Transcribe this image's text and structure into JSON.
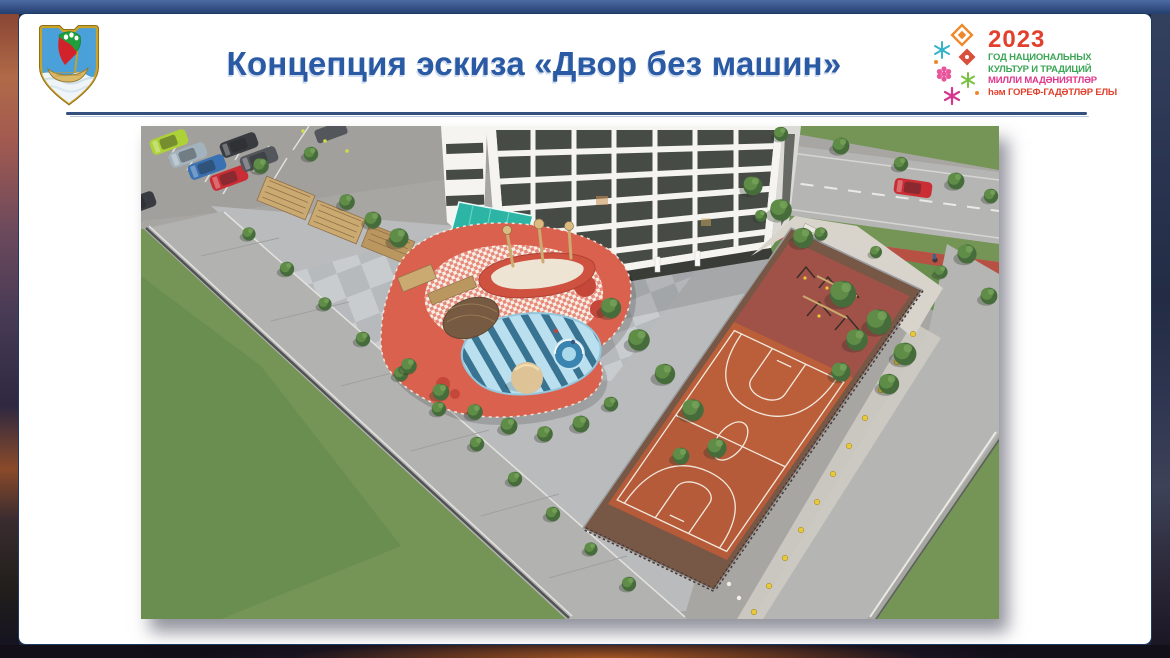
{
  "background": {
    "top_bar_color": "#39558c",
    "edges": {
      "left": "sunset-city-photo",
      "right": "night-city-photo",
      "bottom": "night-road-photo"
    }
  },
  "slide": {
    "title": "Концепция эскиза «Двор без машин»",
    "title_color": "#2b5aa5",
    "divider_color": "#33507e"
  },
  "emblem": {
    "name": "city-coat-of-arms",
    "field": "#4aa0d8",
    "border_gold": "#c9a227",
    "sail_green": "#1fa03c",
    "sail_red": "#d2232a",
    "boat_gold": "#d9b96a",
    "water": "#eef4f8"
  },
  "year_logo": {
    "year": "2023",
    "year_color": "#e2402c",
    "lines": [
      {
        "text": "ГОД НАЦИОНАЛЬНЫХ",
        "color": "#3aa655"
      },
      {
        "text": "КУЛЬТУР И ТРАДИЦИЙ",
        "color": "#3aa655"
      },
      {
        "text": "МИЛЛИ МАДӘНИЯТЛӘР",
        "color": "#e0368c"
      },
      {
        "text": "һәм ГОРЕФ-ГАДӘТЛӘР ЕЛЫ",
        "color": "#e2402c"
      }
    ],
    "ornament_colors": [
      "#f0882a",
      "#35b4c9",
      "#d94f3d",
      "#e8559a",
      "#7ac143",
      "#d6368f"
    ]
  },
  "illustration": {
    "alt": "Аэровид двора без машин: парковка, жилой дом, детская площадка, спортивная площадка, велодорожка",
    "colors": {
      "asphalt": "#a3a3a1",
      "pavement": "#b7b9bb",
      "road": "#b2b4b2",
      "sidewalk": "#aeb0af",
      "lawn": "#6e9150",
      "lawn_dark": "#5f8a46",
      "tree": "#3c6632",
      "tree_light": "#578740",
      "court": "#b15432",
      "court_margin": "#70503e",
      "fitness": "#9c4a41",
      "court_line": "#f3e9dd",
      "playground_red": "#d85a47",
      "checker_white": "#f4efe6",
      "play_blue": "#b7dff0",
      "play_blue_dark": "#2f6d8f",
      "wood": "#c9a76c",
      "sand": "#ddc193",
      "building": "#f5f5f3",
      "building_side": "#d9d9d5",
      "glass": "#3e433e",
      "canopy": "#21b2a3",
      "bike_path": "#b4493c",
      "bollard": "#e8c832",
      "apron": "#d6d3cc",
      "fence": "#8f959b",
      "car_red": "#c8242c",
      "car_lime": "#a9d12f",
      "car_blue": "#2f6bb0",
      "car_silver": "#9fb0bd",
      "car_black": "#2e3237",
      "car_graphite": "#4a4e55"
    }
  }
}
